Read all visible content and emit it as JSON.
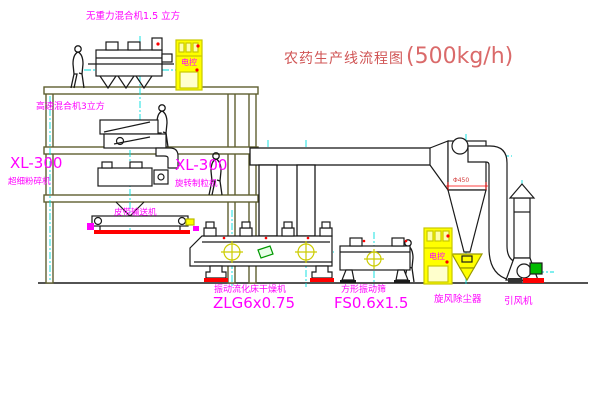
{
  "title": {
    "name": "农药生产线流程图",
    "capacity": "(500kg/h)"
  },
  "labels": {
    "gravity_mixer": "无重力混合机1.5 立方",
    "high_speed_mixer": "高速混合机3立方",
    "mill_left_model": "XL-300",
    "mill_left_name": "超细粉碎机",
    "mill_right_model": "XL-300",
    "mill_right_name": "旋转制粒机",
    "belt_conveyor": "皮带输送机",
    "dryer_name": "振动流化床干燥机",
    "dryer_model": "ZLG6x0.75",
    "sieve_name": "方形振动筛",
    "sieve_model": "FS0.6x1.5",
    "cyclone": "旋风除尘器",
    "fan": "引风机",
    "cyclone_dia": "Φ450",
    "cabinet_mark": "电控"
  },
  "colors": {
    "label_magenta": "#ff00ff",
    "title_red": "#d05555",
    "frame_olive": "#5f5f30",
    "line_black": "#1a1a1a",
    "centerline_cyan": "#00dddd",
    "accent_red": "#ff0000",
    "cabinet_yellow": "#ffff00",
    "fan_motor_green": "#00bb00"
  }
}
